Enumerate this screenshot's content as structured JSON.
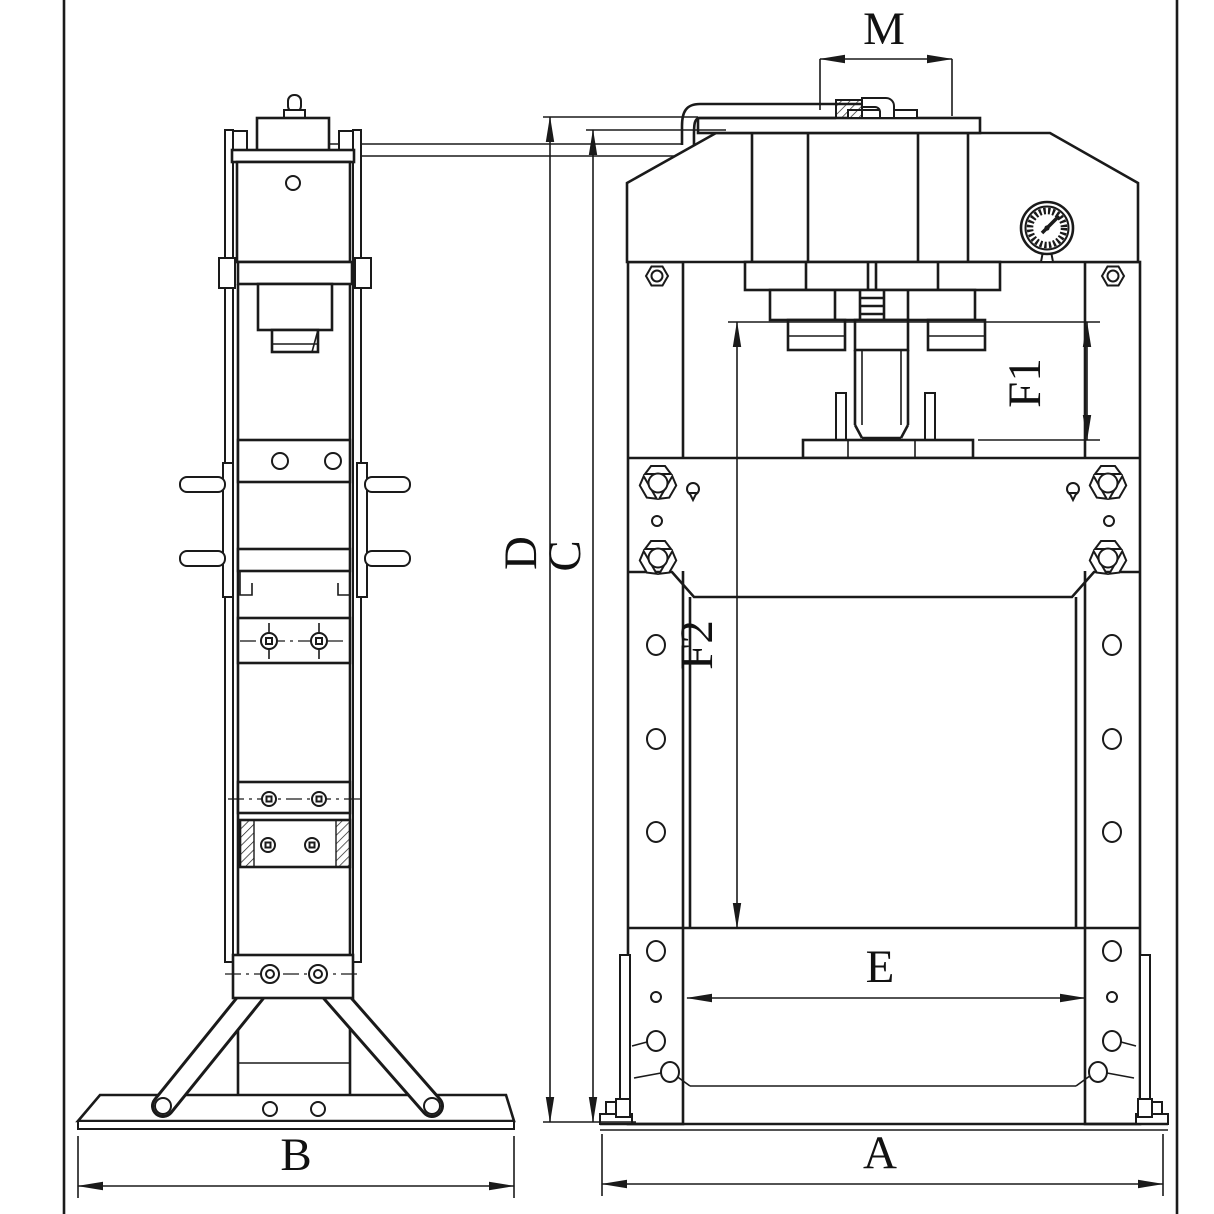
{
  "drawing": {
    "type": "technical-drawing",
    "subject": "hydraulic shop press, two orthographic views",
    "background_color": "#ffffff",
    "line_color": "#1a1a1a",
    "views": {
      "side_view_name": "side view",
      "front_view_name": "front view"
    },
    "components": [
      "pump-knob",
      "pump-body",
      "tie-rods",
      "cylinder",
      "ram",
      "hand-pins",
      "pressure-gauge",
      "hydraulic-hose",
      "frame-columns",
      "work-table",
      "wing-bolts",
      "support-legs",
      "base-plate",
      "foot-brackets"
    ],
    "dimensions": {
      "M": "M",
      "D": "D",
      "C": "C",
      "F1": "F1",
      "F2": "F2",
      "E": "E",
      "B": "B",
      "A": "A"
    }
  }
}
